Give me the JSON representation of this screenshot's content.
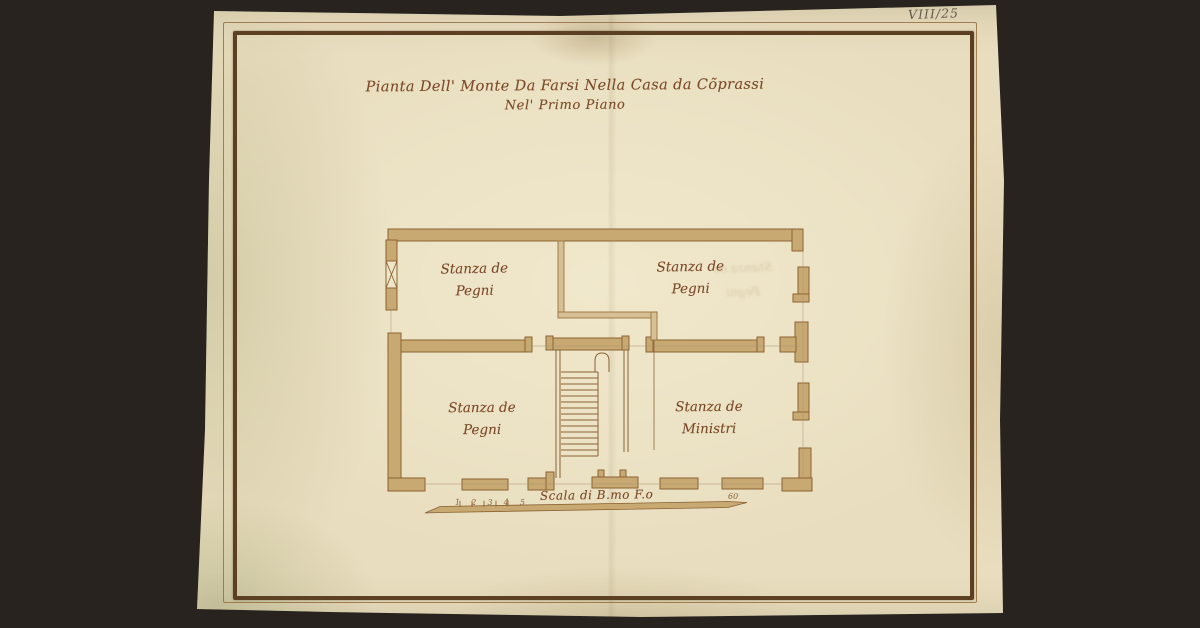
{
  "document": {
    "archive_number": "VIII/25",
    "title_line1": "Pianta Dell' Monte Da Farsi Nella Casa da Cõprassi",
    "title_line2": "Nel' Primo Piano"
  },
  "plan": {
    "rooms": [
      {
        "id": "upper-left",
        "line1": "Stanza de",
        "line2": "Pegni"
      },
      {
        "id": "upper-right",
        "line1": "Stanza de",
        "line2": "Pegni"
      },
      {
        "id": "lower-left",
        "line1": "Stanza de",
        "line2": "Pegni"
      },
      {
        "id": "lower-right",
        "line1": "Stanza de",
        "line2": "Ministri"
      }
    ],
    "bleed_line1": "Stanza de",
    "bleed_line2": "Pegni"
  },
  "scale": {
    "label": "Scala di B.mo F.o",
    "ticks": [
      "1",
      "2",
      "3",
      "4",
      "5"
    ],
    "end_value": "60"
  },
  "colors": {
    "background": "#28231f",
    "paper": "#e8ddbe",
    "ink": "#7b4a28",
    "wall_fill": "#c9a972",
    "wall_outline": "#8a6234",
    "frame_inner": "#5c4023",
    "frame_outer": "#97703f",
    "pencil": "#a89270"
  }
}
